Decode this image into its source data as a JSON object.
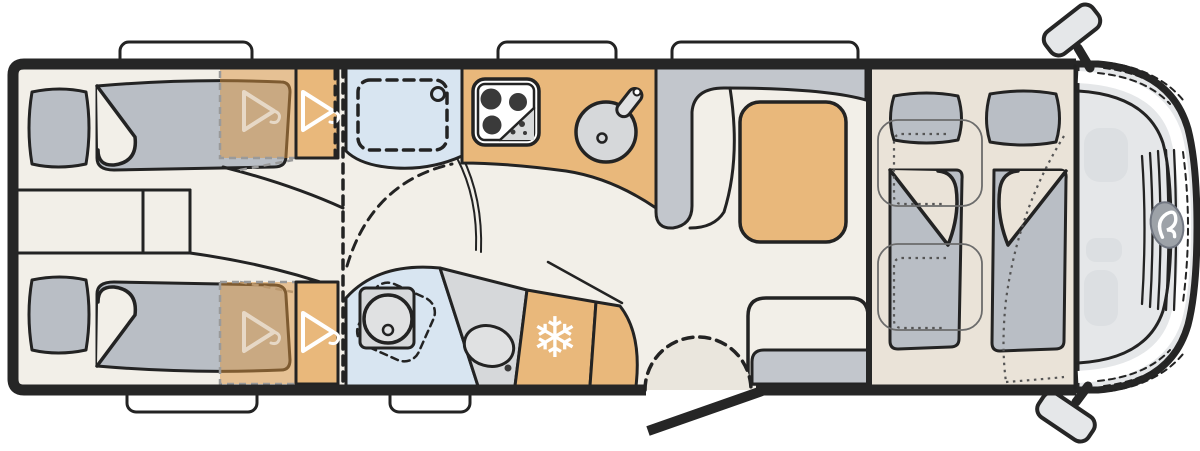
{
  "plan": {
    "subject": "motorhome-floor-plan",
    "regions": [
      "rear-twin-single-beds",
      "bedside-cabinet",
      "wardrobes-with-hangers",
      "sliding-partition",
      "shower-cabin",
      "washroom-swivel-toilet-and-basin",
      "kitchen-block-hob-and-sink",
      "refrigerator",
      "l-shaped-dinette-with-table",
      "side-bench",
      "entrance-door-with-swing",
      "drop-down-double-bed-over-cab",
      "cab-with-two-swivel-seats"
    ]
  },
  "icons": {
    "snowflake_glyph": "❄",
    "hanger": "clothes-hanger-icon",
    "emblem": "brand-emblem-icon"
  },
  "palette": {
    "wall": "#262626",
    "line": "#232323",
    "floor": "#f2efe8",
    "bed_floor": "#eae3d8",
    "mattress": "#b9bec5",
    "upholstery": "#c2c6cc",
    "tan": "#e9b87b",
    "tan_translucent": "rgba(218,148,64,0.5)",
    "blue": "#d8e5f1",
    "fixture": "#d6d8da",
    "fixture_light": "#e0e1e2",
    "hob_dark": "#3a3a3a",
    "cab_body": "#e5e7e9",
    "cab_detail": "#dcdfe2",
    "logo_gray": "#9da2a8",
    "swing": "#eae6dd",
    "window_white": "#ffffff"
  }
}
